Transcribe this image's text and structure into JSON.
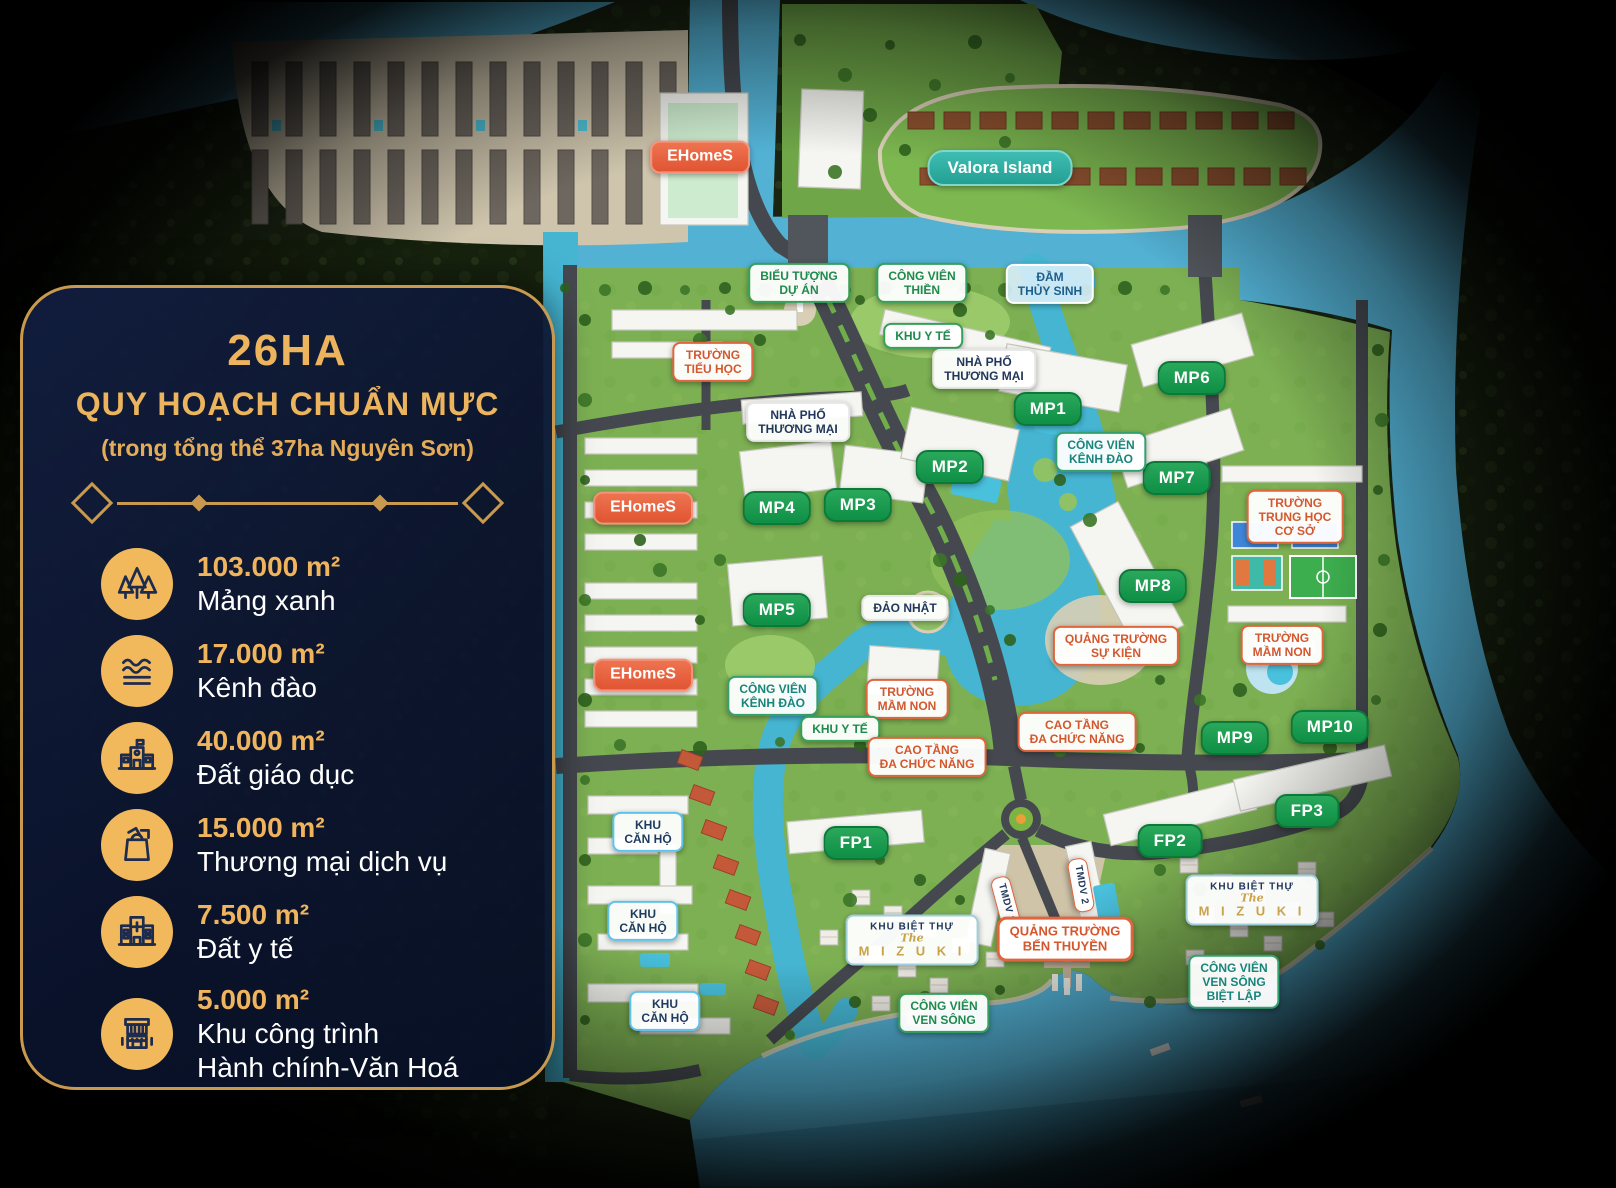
{
  "panel": {
    "area": "26HA",
    "title": "QUY HOẠCH CHUẨN MỰC",
    "subtitle": "(trong tổng thể 37ha Nguyên Sơn)",
    "colors": {
      "gold": "#ECB45C",
      "panel_bg": "#0E1A38",
      "border": "#C99A4E",
      "text": "#FFFFFF"
    },
    "stats": [
      {
        "icon": "trees-icon",
        "value": "103.000 m²",
        "label": "Mảng xanh"
      },
      {
        "icon": "waves-icon",
        "value": "17.000 m²",
        "label": "Kênh đào"
      },
      {
        "icon": "school-icon",
        "value": "40.000 m²",
        "label": "Đất giáo dục"
      },
      {
        "icon": "shopping-bag-icon",
        "value": "15.000 m²",
        "label": "Thương mại dịch vụ"
      },
      {
        "icon": "hospital-icon",
        "value": "7.500 m²",
        "label": "Đất y tế"
      },
      {
        "icon": "civic-building-icon",
        "value": "5.000 m²",
        "label": "Khu công trình\nHành chính-Văn Hoá"
      }
    ]
  },
  "map_colors": {
    "water": "#53B1D4",
    "canal": "#45B5D2",
    "land": "#7DB053",
    "forest": "#1A2412",
    "road": "#45494F",
    "badge_green": "#0E8F45",
    "badge_orange": "#E0643C",
    "ehomes": "#E05532",
    "valora": "#23A093"
  },
  "map_labels": [
    {
      "id": "ehomes-1",
      "text": "EHomeS",
      "variant": "ehomes",
      "x": 700,
      "y": 157
    },
    {
      "id": "valora-island",
      "text": "Valora Island",
      "variant": "valora",
      "x": 1000,
      "y": 168
    },
    {
      "id": "bieu-tuong-du-an",
      "text": "BIỂU TƯỢNG\nDỰ ÁN",
      "variant": "park",
      "x": 799,
      "y": 283
    },
    {
      "id": "cong-vien-thien",
      "text": "CÔNG VIÊN\nTHIỀN",
      "variant": "park",
      "x": 922,
      "y": 283
    },
    {
      "id": "dam-thuy-sinh",
      "text": "ĐẦM\nTHỦY SINH",
      "variant": "wetland",
      "x": 1050,
      "y": 284
    },
    {
      "id": "khu-y-te-1",
      "text": "KHU Y TẾ",
      "variant": "park",
      "x": 923,
      "y": 336
    },
    {
      "id": "truong-tieu-hoc",
      "text": "TRƯỜNG\nTIỂU HỌC",
      "variant": "edu",
      "x": 713,
      "y": 362
    },
    {
      "id": "nha-pho-thuong-mai-1",
      "text": "NHÀ PHỐ\nTHƯƠNG MẠI",
      "variant": "navy",
      "x": 984,
      "y": 369
    },
    {
      "id": "nha-pho-thuong-mai-2",
      "text": "NHÀ PHỐ\nTHƯƠNG MẠI",
      "variant": "navy",
      "x": 798,
      "y": 422
    },
    {
      "id": "mp1",
      "text": "MP1",
      "variant": "green",
      "x": 1048,
      "y": 409
    },
    {
      "id": "mp2",
      "text": "MP2",
      "variant": "green",
      "x": 950,
      "y": 467
    },
    {
      "id": "mp3",
      "text": "MP3",
      "variant": "green",
      "x": 858,
      "y": 505
    },
    {
      "id": "mp4",
      "text": "MP4",
      "variant": "green",
      "x": 777,
      "y": 508
    },
    {
      "id": "mp5",
      "text": "MP5",
      "variant": "green",
      "x": 777,
      "y": 610
    },
    {
      "id": "mp6",
      "text": "MP6",
      "variant": "green",
      "x": 1192,
      "y": 378
    },
    {
      "id": "mp7",
      "text": "MP7",
      "variant": "green",
      "x": 1177,
      "y": 478
    },
    {
      "id": "mp8",
      "text": "MP8",
      "variant": "green",
      "x": 1153,
      "y": 586
    },
    {
      "id": "mp9",
      "text": "MP9",
      "variant": "green",
      "x": 1235,
      "y": 738
    },
    {
      "id": "mp10",
      "text": "MP10",
      "variant": "green",
      "x": 1330,
      "y": 727
    },
    {
      "id": "cong-vien-kenh-dao-1",
      "text": "CÔNG VIÊN\nKÊNH ĐÀO",
      "variant": "park-teal",
      "x": 1101,
      "y": 452
    },
    {
      "id": "cong-vien-kenh-dao-2",
      "text": "CÔNG VIÊN\nKÊNH ĐÀO",
      "variant": "park-teal",
      "x": 773,
      "y": 696
    },
    {
      "id": "truong-trung-hoc-co-so",
      "text": "TRƯỜNG\nTRUNG HỌC\nCƠ SỞ",
      "variant": "edu",
      "x": 1295,
      "y": 517
    },
    {
      "id": "truong-mam-non-1",
      "text": "TRƯỜNG\nMẦM NON",
      "variant": "edu",
      "x": 1282,
      "y": 645
    },
    {
      "id": "truong-mam-non-2",
      "text": "TRƯỜNG\nMẦM NON",
      "variant": "edu",
      "x": 907,
      "y": 699
    },
    {
      "id": "quang-truong-su-kien",
      "text": "QUẢNG TRƯỜNG\nSỰ KIỆN",
      "variant": "edu",
      "x": 1116,
      "y": 646
    },
    {
      "id": "dao-nhat",
      "text": "ĐẢO NHẬT",
      "variant": "navy",
      "x": 905,
      "y": 608
    },
    {
      "id": "ehomes-2",
      "text": "EHomeS",
      "variant": "ehomes",
      "x": 643,
      "y": 508
    },
    {
      "id": "ehomes-3",
      "text": "EHomeS",
      "variant": "ehomes",
      "x": 643,
      "y": 675
    },
    {
      "id": "khu-y-te-2",
      "text": "KHU Y TẾ",
      "variant": "park",
      "x": 840,
      "y": 729
    },
    {
      "id": "cao-tang-da-chuc-nang-1",
      "text": "CAO TẦNG\nĐA CHỨC NĂNG",
      "variant": "edu",
      "x": 927,
      "y": 757
    },
    {
      "id": "cao-tang-da-chuc-nang-2",
      "text": "CAO TẦNG\nĐA CHỨC NĂNG",
      "variant": "edu",
      "x": 1077,
      "y": 732
    },
    {
      "id": "khu-can-ho-1",
      "text": "KHU\nCĂN HỘ",
      "variant": "khucanho",
      "x": 648,
      "y": 832
    },
    {
      "id": "khu-can-ho-2",
      "text": "KHU\nCĂN HỘ",
      "variant": "khucanho",
      "x": 643,
      "y": 921
    },
    {
      "id": "khu-can-ho-3",
      "text": "KHU\nCĂN HỘ",
      "variant": "khucanho",
      "x": 665,
      "y": 1011
    },
    {
      "id": "fp1",
      "text": "FP1",
      "variant": "green",
      "x": 856,
      "y": 843
    },
    {
      "id": "fp2",
      "text": "FP2",
      "variant": "green",
      "x": 1170,
      "y": 841
    },
    {
      "id": "fp3",
      "text": "FP3",
      "variant": "green",
      "x": 1307,
      "y": 811
    },
    {
      "id": "tmdv-1",
      "text": "TMDV 1",
      "variant": "tmdv",
      "x": 1006,
      "y": 903,
      "rotate": 75
    },
    {
      "id": "tmdv-2",
      "text": "TMDV 2",
      "variant": "tmdv",
      "x": 1081,
      "y": 885,
      "rotate": 80
    },
    {
      "id": "khu-biet-thu-mizuki-1",
      "variant": "mizuki",
      "x": 912,
      "y": 940,
      "lines": [
        "KHU BIỆT THỰ",
        "The",
        "M I Z U K I"
      ]
    },
    {
      "id": "khu-biet-thu-mizuki-2",
      "variant": "mizuki",
      "x": 1252,
      "y": 900,
      "lines": [
        "KHU BIỆT THỰ",
        "The",
        "M I Z U K I"
      ]
    },
    {
      "id": "quang-truong-ben-thuyen",
      "text": "QUẢNG TRƯỜNG\nBẾN THUYỀN",
      "variant": "benthuyen",
      "x": 1065,
      "y": 939
    },
    {
      "id": "cong-vien-ven-song",
      "text": "CÔNG VIÊN\nVEN SÔNG",
      "variant": "park",
      "x": 944,
      "y": 1013
    },
    {
      "id": "cong-vien-ven-song-biet-lap",
      "text": "CÔNG VIÊN\nVEN SÔNG\nBIỆT LẬP",
      "variant": "park-teal",
      "x": 1234,
      "y": 982
    }
  ]
}
